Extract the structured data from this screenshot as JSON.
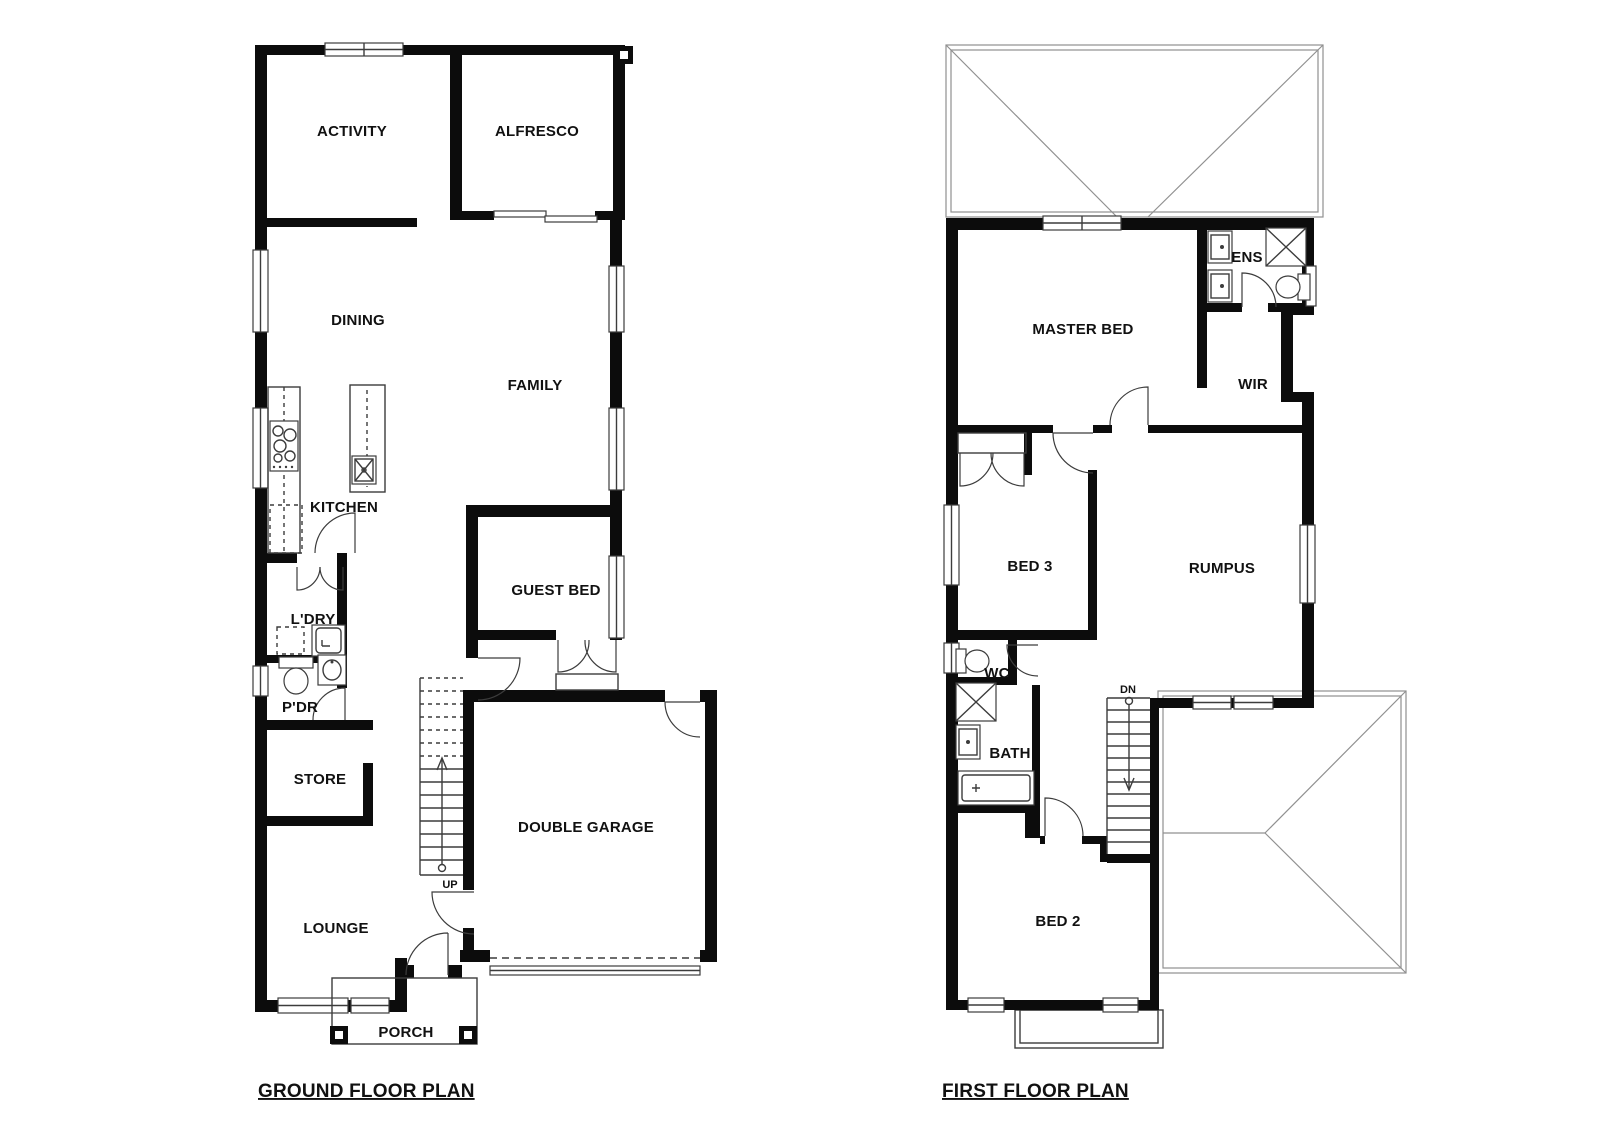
{
  "ground_floor": {
    "title": "GROUND FLOOR PLAN",
    "stair_label": "UP",
    "rooms": {
      "activity": "ACTIVITY",
      "alfresco": "ALFRESCO",
      "dining": "DINING",
      "family": "FAMILY",
      "kitchen": "KITCHEN",
      "guest_bed": "GUEST BED",
      "laundry": "L'DRY",
      "powder": "P'DR",
      "store": "STORE",
      "lounge": "LOUNGE",
      "double_garage": "DOUBLE GARAGE",
      "porch": "PORCH"
    }
  },
  "first_floor": {
    "title": "FIRST FLOOR PLAN",
    "stair_label": "DN",
    "rooms": {
      "master_bed": "MASTER BED",
      "ensuite": "ENS",
      "wir": "WIR",
      "bed3": "BED 3",
      "rumpus": "RUMPUS",
      "wc": "WC",
      "bath": "BATH",
      "bed2": "BED 2"
    }
  },
  "colors": {
    "wall": "#0c0c0c",
    "line": "#3c3c3c",
    "roof": "#909090",
    "background": "#ffffff",
    "text": "#111111"
  }
}
